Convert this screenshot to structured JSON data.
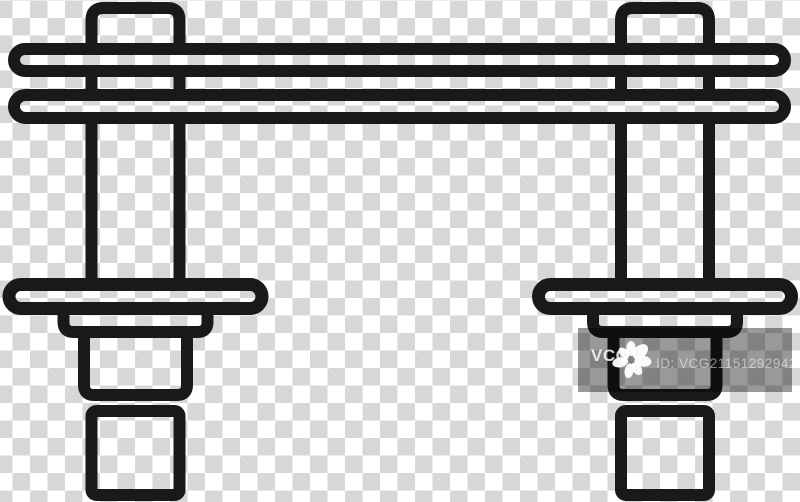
{
  "canvas": {
    "background": "transparency-checkerboard",
    "checker_white": "#ffffff",
    "checker_gray": "#d7d7d7"
  },
  "icon": {
    "name": "bridge-overpass-line-icon",
    "color": "#191919"
  },
  "watermark": {
    "brand": "VCG",
    "id_text": "ID: VCG211512929427",
    "band_color": "rgba(0,0,0,0.4)",
    "text_color": "#ffffff"
  }
}
